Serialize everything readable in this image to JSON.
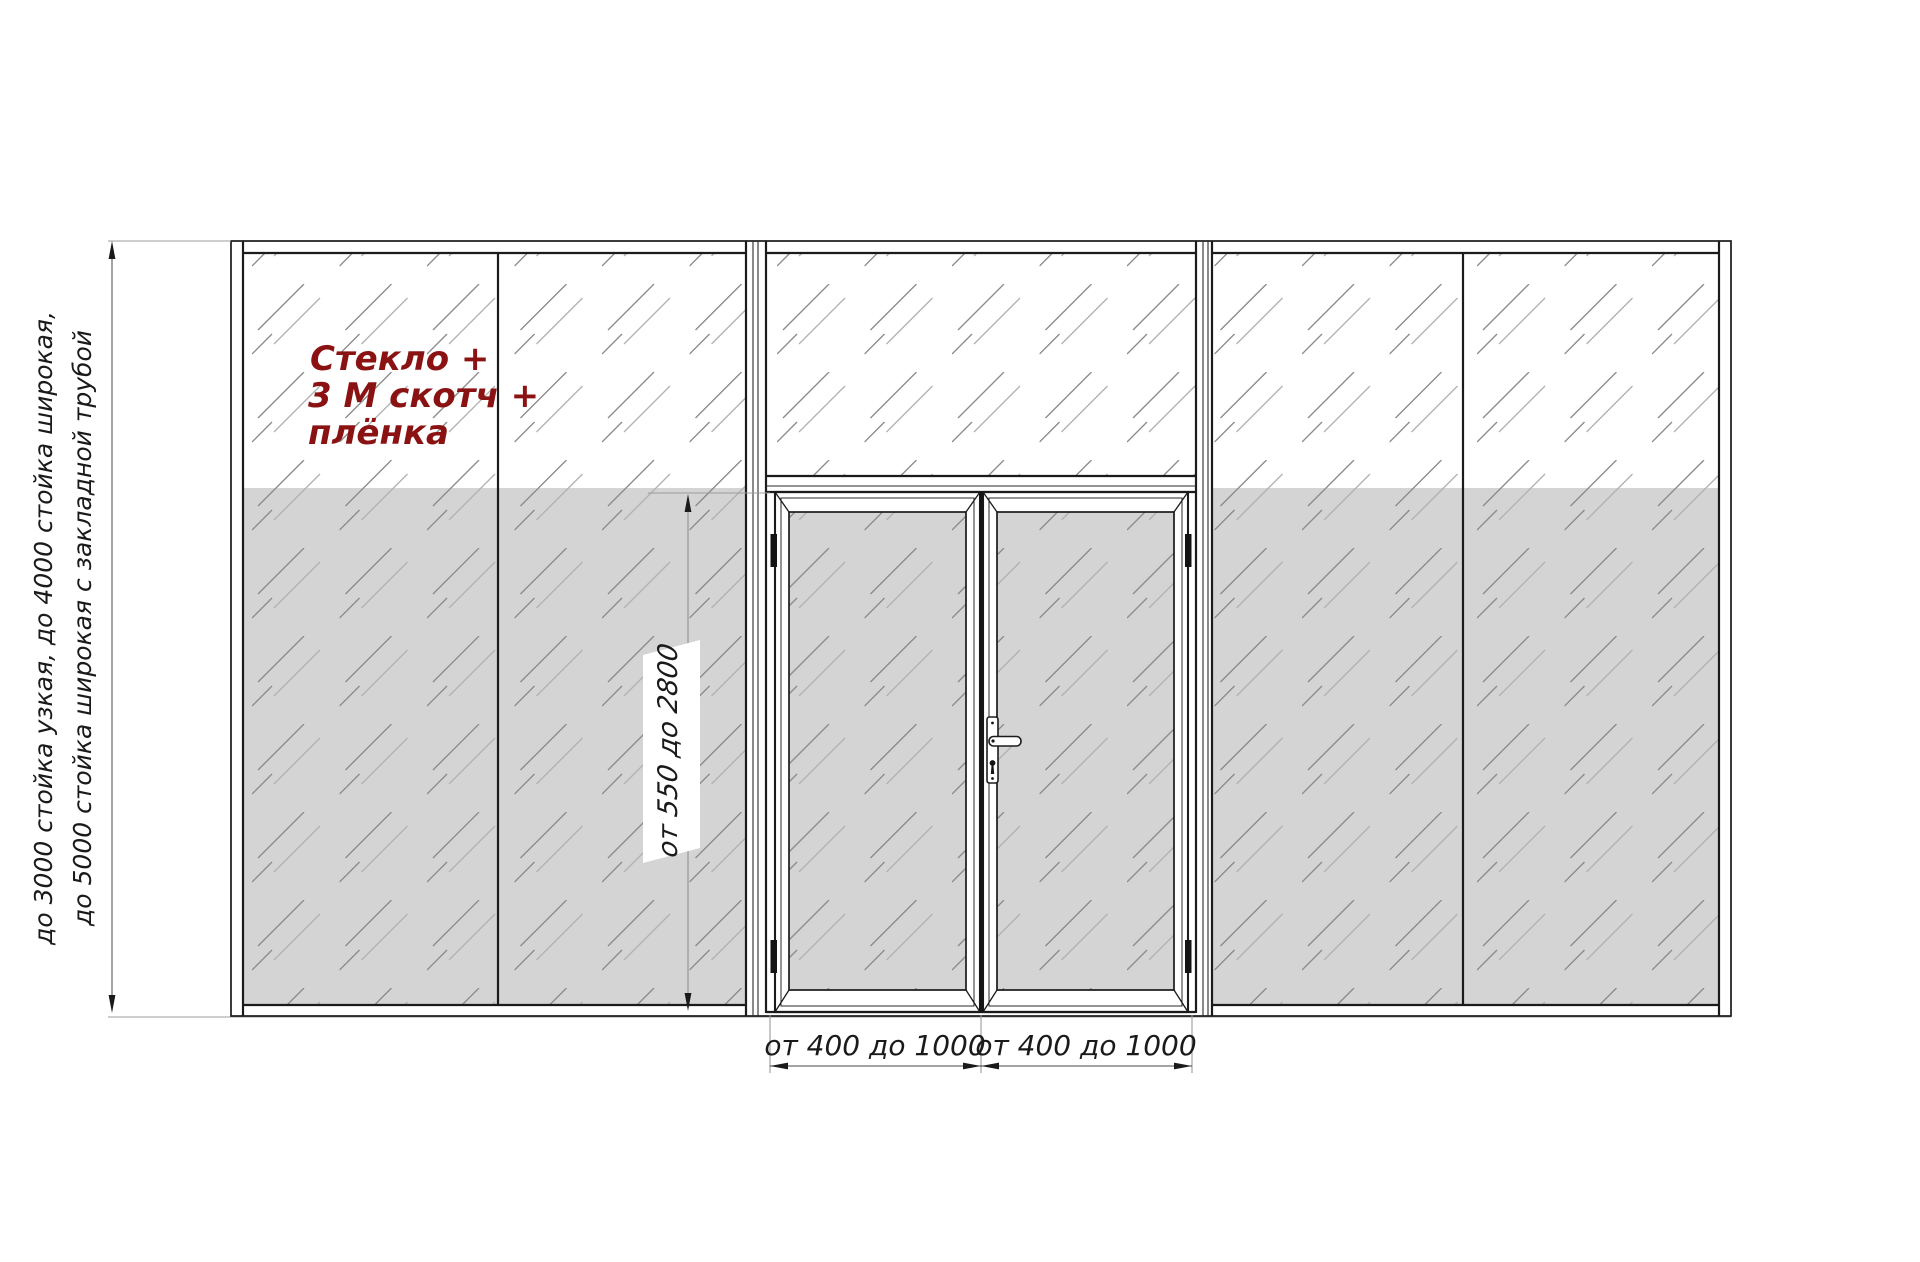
{
  "drawing": {
    "type": "partition-elevation",
    "description_visible": false
  },
  "annotations": {
    "glass_note": {
      "lines": [
        "Стекло +",
        "3 М скотч +",
        "плёнка"
      ],
      "color": "#8b1212"
    },
    "left_dim": {
      "lines": [
        "до 3000 стойка узкая, до 4000 стойка широкая,",
        "до 5000 стойка широкая с закладной трубой"
      ]
    },
    "door_height_dim": {
      "label": "от 550 до 2800"
    },
    "leaf_width_dims": [
      {
        "label": "от 400 до 1000"
      },
      {
        "label": "от 400 до 1000"
      }
    ]
  },
  "colors": {
    "line": "#1b1b1b",
    "glass_film_gray": "#d4d4d4",
    "hatch_dark": "#8a8a8a",
    "hatch_light": "#b2b2b2",
    "note_red": "#8b1212",
    "dim_gray": "#9c9c9c"
  }
}
